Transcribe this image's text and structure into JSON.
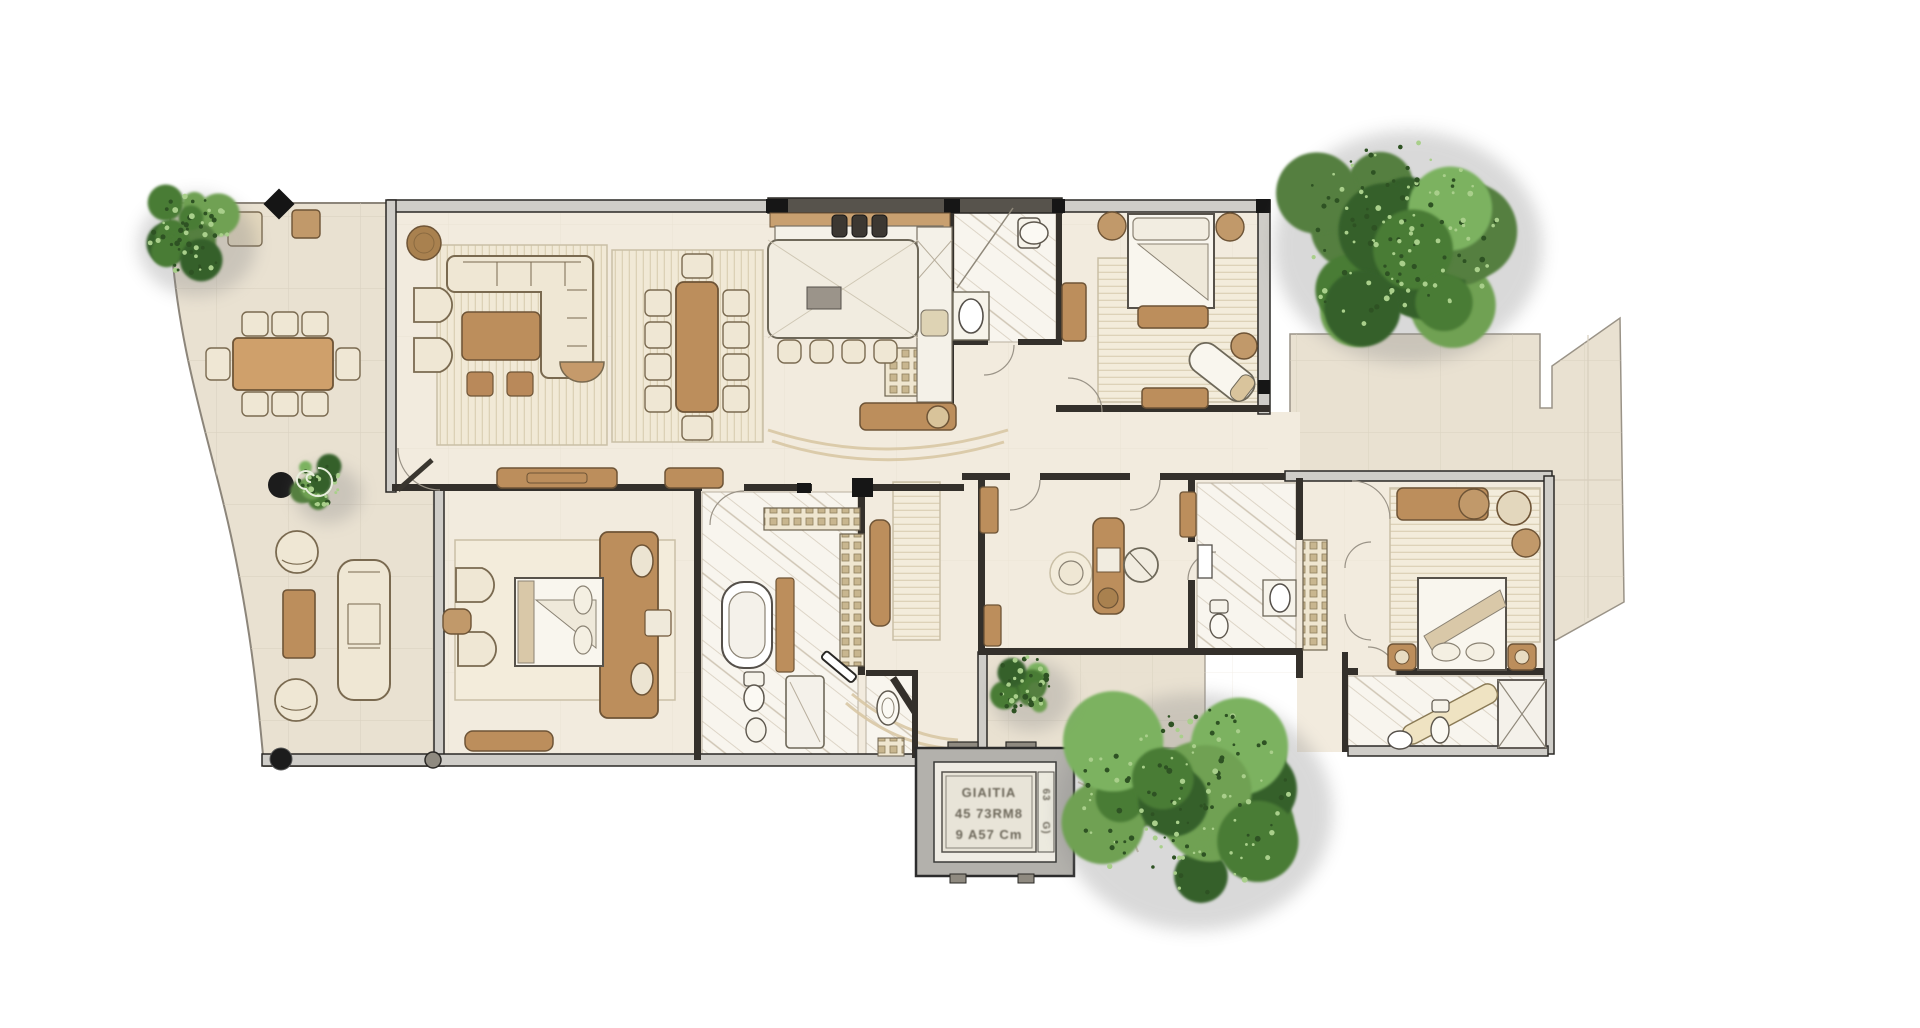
{
  "scene": {
    "type": "furnished-floor-plan-rendering",
    "canvas": {
      "width": 1920,
      "height": 1028,
      "background": "#ffffff"
    }
  },
  "title_block": {
    "lines": [
      "GIAITIA",
      "45 73RM8",
      "9 A57 Cm"
    ],
    "side_marks": [
      "63",
      "G)"
    ]
  },
  "palette": {
    "background": "#ffffff",
    "terrace_floor": "#e9e1d1",
    "interior_floor": "#f2ebde",
    "marble_floor": "#f8f5ee",
    "wall_band": "#cfcdc8",
    "wall_line": "#2a2825",
    "wall_dark": "#57534c",
    "wood": "#bc8e5c",
    "wood_line": "#6e5436",
    "light_upholstery": "#efe7d4",
    "rug": "#f3ecdb",
    "foliage_dark": "#35602a",
    "foliage_mid": "#4a7c36",
    "foliage_light": "#7cb261",
    "accent_black": "#161616"
  },
  "region_names": [
    "left-terrace",
    "living-room",
    "dining-area",
    "kitchen",
    "bathroom-top",
    "bedroom-top-right",
    "hallway",
    "master-bedroom",
    "master-bathroom",
    "powder-room",
    "foyer",
    "office",
    "office-bathroom",
    "closet",
    "bedroom-bottom-right",
    "bathroom-bottom-right",
    "elevator-block",
    "right-terrace",
    "bottom-terrace"
  ],
  "trees": [
    {
      "id": "tree-top-left",
      "cx": 187,
      "cy": 233,
      "r": 58
    },
    {
      "id": "tree-top-right",
      "cx": 1398,
      "cy": 235,
      "r": 132
    },
    {
      "id": "tree-bottom",
      "cx": 1185,
      "cy": 800,
      "r": 135
    },
    {
      "id": "shrub-elevator",
      "cx": 1022,
      "cy": 684,
      "r": 40
    },
    {
      "id": "plant-terrace",
      "cx": 318,
      "cy": 482,
      "r": 33
    }
  ]
}
